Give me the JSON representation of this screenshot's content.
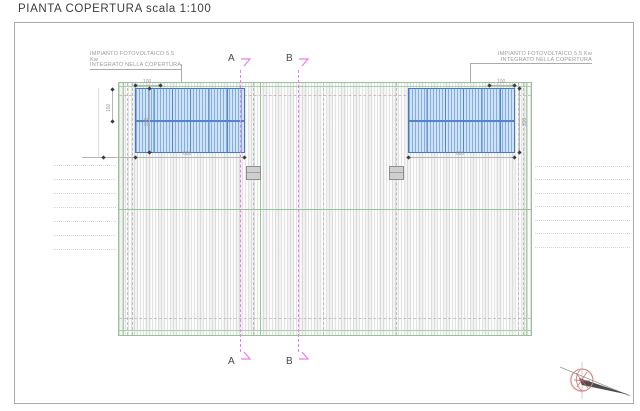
{
  "title": "PIANTA COPERTURA  scala 1:100",
  "plan": {
    "section_labels": {
      "a": "A",
      "b": "B"
    },
    "pv_label_left": {
      "line1": "IMPIANTO FOTOVOLTAICO 5.5 Kw",
      "line2": "INTEGRATO NELLA COPERTURA"
    },
    "pv_label_right": {
      "line1": "IMPIANTO FOTOVOLTAICO 5.5 Kw",
      "line2": "INTEGRATO NELLA COPERTURA"
    },
    "dimensions": {
      "left_array_width": "600",
      "right_array_width": "600",
      "left_array_height": "330",
      "right_array_height": "330",
      "left_module_width": "100",
      "right_module_width": "100",
      "left_edge_offset": "150"
    },
    "colors": {
      "roof_outline": "#96c496",
      "pv_fill": "#cfe3f8",
      "pv_border": "#4679bd",
      "section_line": "#ee7ce8",
      "dimension": "#b5b5b5",
      "compass_red": "#c46a6a"
    }
  }
}
